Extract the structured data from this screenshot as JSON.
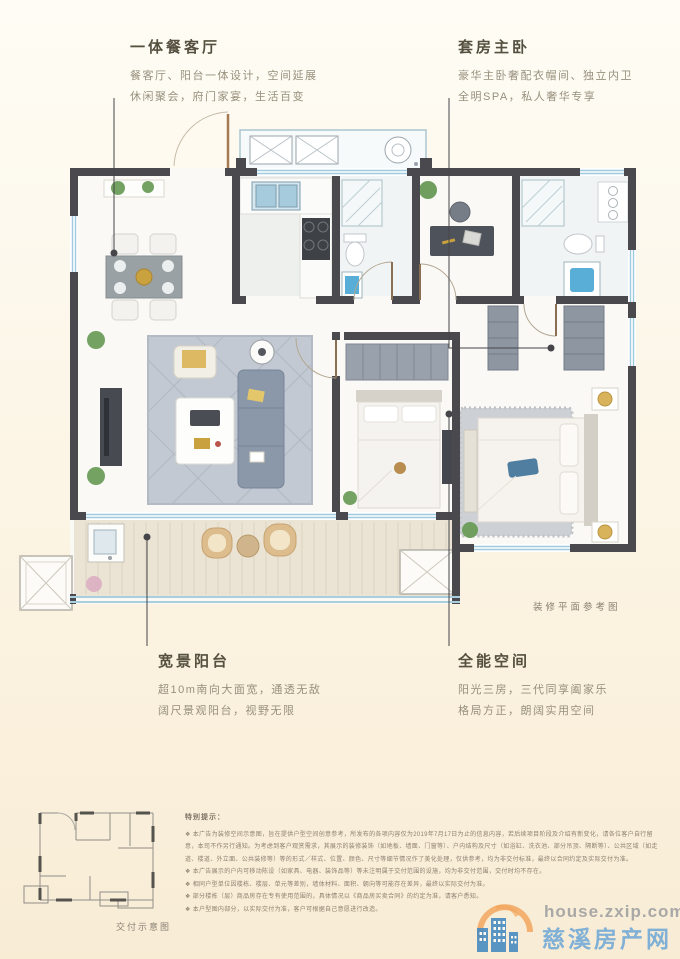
{
  "annotations": {
    "dining_living": {
      "title": "一体餐客厅",
      "lines": [
        "餐客厅、阳台一体设计，空间延展",
        "休闲聚会，府门家宴，生活百变"
      ]
    },
    "master_suite": {
      "title": "套房主卧",
      "lines": [
        "豪华主卧奢配衣帽间、独立内卫",
        "全明SPA，私人奢华专享"
      ]
    },
    "wide_balcony": {
      "title": "宽景阳台",
      "lines": [
        "超10m南向大面宽，通透无敌",
        "阔尺景观阳台，视野无限"
      ]
    },
    "all_purpose": {
      "title": "全能空间",
      "lines": [
        "阳光三房，三代同享阖家乐",
        "格局方正，朗阔实用空间"
      ]
    }
  },
  "plan_caption": "装修平面参考图",
  "delivery_caption": "交付示意图",
  "disclaimer": {
    "title": "特别提示：",
    "items": [
      "本广告为装修空间示意图，旨在提供户型空间创意参考，所发布的各项内容仅为2019年7月17日为止的信息内容，若后续项目阶段及介绍有新变化，请各位客户自行留意，本司不作另行通知。为考虑到客户观赏需求，其展示的装修装饰（如地板、墙面、门窗等）、户内结构及尺寸（如浴缸、洗衣池、部分吊顶、隔断等）、公共区域（如走道、楼道、外立面、公共装修等）等的形式／样式、位置、颜色、尺寸等细节情况作了美化处理，仅供参考，均为非交付标准，最终以合同约定及实际交付为准。",
      "本广告展示的户内可移动陈设（如家具、电器、装饰品等）等未注明属于交付范围的设施，均为非交付范围，交付时均不存在。",
      "相同户型单位因楼栋、楼层、单元等差别，墙体材料、面积、朝向等可能存在差异，最终以实际交付为准。",
      "部分楼栋（层）商品房存在专有使用范围的，具体情况以《商品房买卖合同》的约定为准，请客户悉知。",
      "本户型图内部分，以实际交付为准，客户可根据自己意愿进行改造。"
    ]
  },
  "watermark": {
    "domain": "house.zxip.com",
    "site_name": "慈溪房产网"
  },
  "colors": {
    "wall": "#4a4a4e",
    "glass_blue": "#9fcbe0",
    "fixture_blue": "#58aed6",
    "accent_orange": "#f2a259",
    "accent_blue": "#4288c0"
  }
}
